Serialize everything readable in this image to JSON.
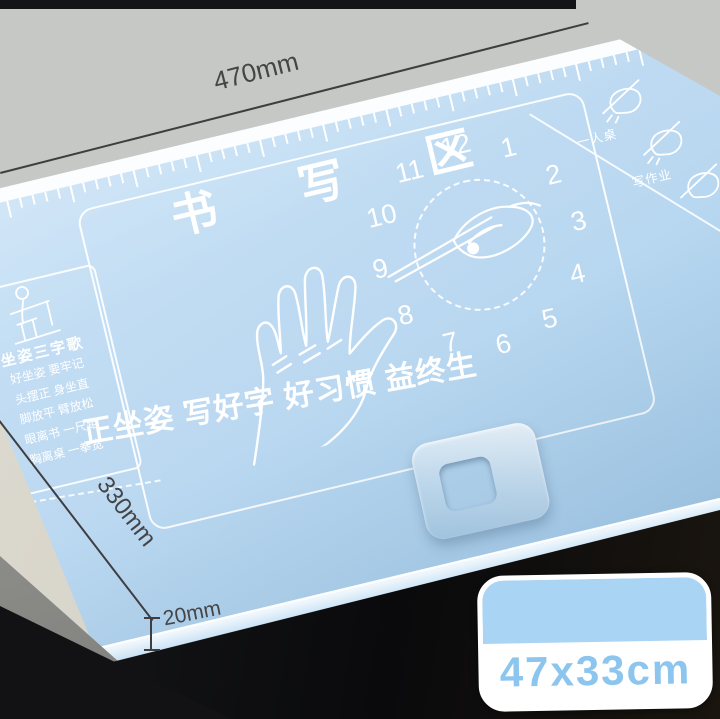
{
  "product_annotations": {
    "width": "470mm",
    "depth": "330mm",
    "lip_height": "20mm",
    "size_badge": "47x33cm"
  },
  "mat": {
    "writing_area_title": "书 写 区",
    "slogan": "正坐姿 写好字 好习惯 益终生",
    "posture_song": {
      "title": "坐姿三字歌",
      "lines": [
        "好坐姿 要牢记",
        "头摆正 身坐直",
        "脚放平 臂放松",
        "眼离书 一尺距",
        "胸离桌 一拳宽"
      ]
    },
    "clock_numbers": [
      "1",
      "2",
      "3",
      "4",
      "5",
      "6",
      "7",
      "8",
      "9",
      "10",
      "11",
      "12"
    ],
    "corner_icon_labels": [
      "一人桌",
      "写作业"
    ]
  },
  "icons": {
    "sitting-posture-icon": "child seated at desk line-art",
    "hand-outline-icon": "open left hand line-art",
    "pen-hand-icon": "hand holding pen at clock center",
    "pen-grip-icon": "hand gripping pen",
    "clock-tick-ring": "dashed minute ring"
  },
  "colors": {
    "mat_blue": "#bcd9f1",
    "mat_blue_deep": "#a8cfec",
    "line_white": "#ffffff",
    "desk_gray": "#c6c8c5",
    "desk_beige": "#d6d3c9",
    "desk_edge_gray": "#8a8a87",
    "under_desk_shadow": "#101113",
    "badge_blue": "#a9d4f3",
    "badge_text_blue": "#8cc5ee",
    "dimension_ink": "#3e3e40"
  }
}
